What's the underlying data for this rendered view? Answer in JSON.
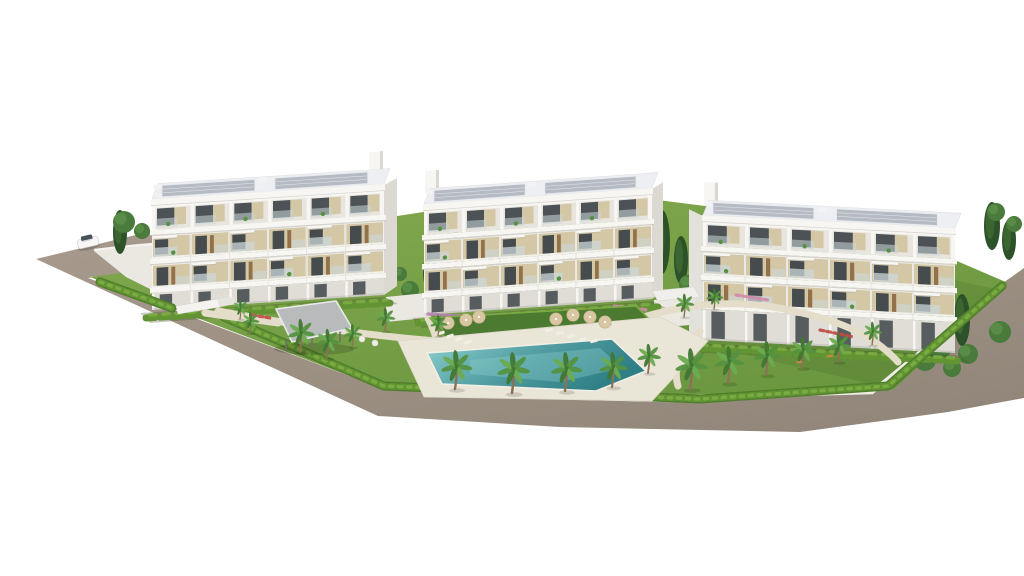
{
  "scene": {
    "type": "architectural-render",
    "description": "Aerial 3D rendering of a modern residential complex: three white four-storey apartment buildings with beige panels, glass balconies and grey rooftop solar panels, set in landscaped gardens with palm trees, cypresses, hedges, a turquoise communal swimming pool with sun loungers and parasols, a grey carport pergola, an entrance gate and a white car on the tan perimeter road. Pure white background.",
    "background": "#ffffff"
  },
  "palette": {
    "road": "#9e9184",
    "roadDark": "#92867a",
    "roadLight": "#a89b8d",
    "curb": "#d6cfbf",
    "lawn": "#83a94f",
    "lawnDark": "#6b9740",
    "loungerLawn": "#4d7a31",
    "hedge": "#4e7d2c",
    "hedgeMid": "#639433",
    "hedgeLight": "#7aab42",
    "deck": "#e9e5d7",
    "path": "#e4ddc9",
    "poolDeep": "#2f7f86",
    "pool": "#4f9ba0",
    "poolLight": "#8ed0cf",
    "facade": "#f2f0ec",
    "facadeShade": "#e0ddd6",
    "endFace": "#dcd9d2",
    "fascia": "#f7f6f3",
    "slabShadow": "#c6c3bc",
    "attic": "#e8e5df",
    "beige": "#d4c7a5",
    "wood": "#93714b",
    "glass": "#3e4549",
    "railing": "#ccd7d9",
    "roof": "#edeff2",
    "roofPanel": "#b5bac3",
    "roofLine": "#e7eaee",
    "roofBox": "#f2f3f5",
    "canopy": "#b8babc",
    "canopyEdge": "#e9eaeb",
    "legs": "#6f6f6f",
    "cypress": "#2d5129",
    "cypressLight": "#3e6b33",
    "tree": "#4a7a3c",
    "treeLight": "#5c8f48",
    "palmG": "#549140",
    "palmL": "#6cab50",
    "palmD": "#417732",
    "trunk": "#8b7254",
    "parasol": "#d9c7a3",
    "lounger": "#f1eee6",
    "bench": "#c08a45",
    "flowerPurple": "#b67fb4",
    "flowerRed": "#bf4a42",
    "flowerPink": "#d389a8",
    "wallWhite": "#efede6",
    "car": "#f7f7f7",
    "carGlass": "#47525a",
    "shadow": "#3c4628"
  },
  "road": {
    "points": [
      [
        173,
        226
      ],
      [
        36,
        259
      ],
      [
        378,
        416
      ],
      [
        560,
        427
      ],
      [
        800,
        432
      ],
      [
        948,
        412
      ],
      [
        1024,
        398
      ],
      [
        1024,
        268
      ],
      [
        965,
        310
      ],
      [
        893,
        390
      ],
      [
        700,
        403
      ],
      [
        500,
        398
      ],
      [
        384,
        389
      ],
      [
        88,
        278
      ],
      [
        236,
        261
      ]
    ],
    "curb": "M 92,277 L 384,388 L 700,402 L 891,389 L 1006,284"
  },
  "ground": {
    "lawn": [
      [
        238,
        258
      ],
      [
        90,
        277
      ],
      [
        384,
        389
      ],
      [
        700,
        403
      ],
      [
        893,
        390
      ],
      [
        1008,
        283
      ],
      [
        950,
        258
      ],
      [
        760,
        213
      ],
      [
        650,
        199
      ],
      [
        430,
        211
      ],
      [
        240,
        240
      ]
    ],
    "lawnShade": [
      [
        640,
        330
      ],
      [
        893,
        389
      ],
      [
        1000,
        290
      ],
      [
        900,
        268
      ],
      [
        700,
        300
      ]
    ],
    "driveway": [
      [
        94,
        251
      ],
      [
        152,
        245
      ],
      [
        238,
        302
      ],
      [
        196,
        312
      ],
      [
        126,
        277
      ]
    ],
    "hedgeSegs": [
      "M 100,282 L 172,308",
      "M 224,317 L 384,386 L 700,399 L 888,386 L 1002,286"
    ],
    "wall": "M 640,398 L 872,392 L 1000,287",
    "gapWalls": [
      [
        [
          386,
          297
        ],
        [
          426,
          293
        ],
        [
          426,
          318
        ],
        [
          386,
          322
        ]
      ],
      [
        [
          654,
          300
        ],
        [
          702,
          296
        ],
        [
          702,
          324
        ],
        [
          654,
          328
        ]
      ]
    ],
    "paths": [
      "M 218,311 C 320,330 400,338 436,341",
      "M 428,318 C 434,330 436,336 436,341",
      "M 640,318 C 700,300 752,300 802,313 C 852,324 880,342 898,362",
      "M 700,331 C 682,350 672,366 678,386",
      "M 205,313 C 238,318 258,320 278,323"
    ]
  },
  "pool": {
    "deck": [
      [
        398,
        341
      ],
      [
        660,
        317
      ],
      [
        708,
        341
      ],
      [
        652,
        401
      ],
      [
        424,
        397
      ]
    ],
    "water": [
      [
        427,
        353
      ],
      [
        612,
        339
      ],
      [
        646,
        371
      ],
      [
        596,
        391
      ],
      [
        442,
        384
      ]
    ],
    "inner": [
      [
        470,
        360
      ],
      [
        600,
        348
      ],
      [
        622,
        368
      ],
      [
        560,
        382
      ],
      [
        470,
        374
      ]
    ],
    "loungerLawn": [
      [
        430,
        318
      ],
      [
        636,
        306
      ],
      [
        662,
        332
      ],
      [
        452,
        346
      ]
    ]
  },
  "structures": {
    "pergola": {
      "canopy": [
        [
          276,
          309
        ],
        [
          336,
          301
        ],
        [
          352,
          328
        ],
        [
          292,
          342
        ]
      ],
      "legs": [
        [
          286,
          340,
          351
        ],
        [
          312,
          336,
          348
        ],
        [
          340,
          330,
          342
        ]
      ],
      "shadow": [
        314,
        349,
        40,
        6
      ]
    },
    "gateBeam": [
      [
        176,
        306
      ],
      [
        218,
        299
      ],
      [
        220,
        307
      ],
      [
        178,
        314
      ]
    ],
    "gateWall": [
      [
        218,
        299
      ],
      [
        234,
        297
      ],
      [
        235,
        304
      ],
      [
        220,
        307
      ]
    ],
    "seatCanopy": [
      [
        652,
        291
      ],
      [
        694,
        287
      ],
      [
        700,
        297
      ],
      [
        658,
        301
      ]
    ]
  },
  "buildings": [
    {
      "id": "building-left",
      "x": 152,
      "y": 206,
      "w": 232,
      "slope": -15,
      "h": 104,
      "modules": 6,
      "end": "right",
      "endW": 13,
      "tower": "right"
    },
    {
      "id": "building-middle",
      "x": 424,
      "y": 211,
      "w": 228,
      "slope": -16,
      "h": 104,
      "modules": 6,
      "end": "right",
      "endW": 11,
      "tower": "left"
    },
    {
      "id": "building-right",
      "x": 703,
      "y": 222,
      "w": 252,
      "slope": 13,
      "h": 118,
      "modules": 6,
      "end": "left",
      "endW": 14,
      "tower": "left"
    }
  ],
  "vegetation": {
    "palms": [
      [
        300,
        352,
        0.85
      ],
      [
        327,
        358,
        0.75
      ],
      [
        352,
        347,
        0.6
      ],
      [
        250,
        333,
        0.55
      ],
      [
        385,
        331,
        0.6
      ],
      [
        455,
        389,
        1.0
      ],
      [
        512,
        393,
        1.05
      ],
      [
        565,
        391,
        1.0
      ],
      [
        612,
        387,
        0.9
      ],
      [
        648,
        373,
        0.75
      ],
      [
        690,
        389,
        1.05
      ],
      [
        728,
        383,
        0.95
      ],
      [
        766,
        375,
        0.88
      ],
      [
        802,
        368,
        0.8
      ],
      [
        838,
        362,
        0.75
      ],
      [
        684,
        317,
        0.6
      ],
      [
        714,
        309,
        0.55
      ],
      [
        240,
        319,
        0.5
      ],
      [
        438,
        336,
        0.55
      ],
      [
        872,
        345,
        0.6
      ]
    ],
    "cypresses": [
      [
        452,
        247,
        9,
        30
      ],
      [
        430,
        272,
        7,
        20
      ],
      [
        496,
        262,
        8,
        22
      ],
      [
        662,
        242,
        8,
        32
      ],
      [
        681,
        260,
        7,
        24
      ],
      [
        940,
        302,
        9,
        32
      ],
      [
        962,
        320,
        8,
        26
      ],
      [
        922,
        284,
        7,
        22
      ],
      [
        992,
        226,
        8,
        24
      ],
      [
        1009,
        240,
        7,
        20
      ],
      [
        120,
        232,
        7,
        22
      ]
    ],
    "bushes": [
      [
        502,
        284,
        11
      ],
      [
        526,
        289,
        9
      ],
      [
        688,
        284,
        9
      ],
      [
        940,
        347,
        12
      ],
      [
        968,
        354,
        10
      ],
      [
        1000,
        332,
        11
      ],
      [
        996,
        212,
        9
      ],
      [
        1014,
        224,
        8
      ],
      [
        918,
        322,
        9
      ],
      [
        896,
        312,
        8
      ],
      [
        925,
        360,
        11
      ],
      [
        952,
        368,
        9
      ],
      [
        124,
        222,
        11
      ],
      [
        142,
        231,
        8
      ],
      [
        410,
        290,
        9
      ],
      [
        400,
        274,
        7
      ]
    ],
    "flowerBeds": [
      {
        "d": "M 428,314 L 518,320",
        "color": "flowerPurple"
      },
      {
        "d": "M 536,322 L 598,328",
        "color": "flowerPurple"
      },
      {
        "d": "M 614,306 L 648,310",
        "color": "flowerPink"
      },
      {
        "d": "M 300,311 L 342,317",
        "color": "flowerRed"
      },
      {
        "d": "M 252,315 L 270,318",
        "color": "flowerRed"
      },
      {
        "d": "M 820,330 L 854,337",
        "color": "flowerRed"
      },
      {
        "d": "M 736,295 L 768,300",
        "color": "flowerPink"
      }
    ]
  },
  "furniture": {
    "parasols": [
      [
        466,
        320
      ],
      [
        479,
        317
      ],
      [
        448,
        323
      ],
      [
        556,
        319
      ],
      [
        573,
        315
      ],
      [
        590,
        317
      ],
      [
        605,
        322
      ]
    ],
    "loungers": [
      [
        441,
        333,
        -18
      ],
      [
        450,
        336,
        -18
      ],
      [
        459,
        339,
        -18
      ],
      [
        468,
        342,
        -18
      ],
      [
        549,
        330,
        -14
      ],
      [
        560,
        333,
        -14
      ],
      [
        571,
        336,
        -14
      ],
      [
        583,
        339,
        -14
      ],
      [
        594,
        341,
        -14
      ]
    ],
    "tables": [
      [
        362,
        339
      ],
      [
        375,
        343
      ]
    ],
    "benches": [
      [
        772,
        357,
        -6
      ],
      [
        800,
        362,
        -4
      ],
      [
        830,
        356,
        -8
      ]
    ]
  },
  "car": {
    "x": 76,
    "y": 237,
    "rot": -13
  }
}
